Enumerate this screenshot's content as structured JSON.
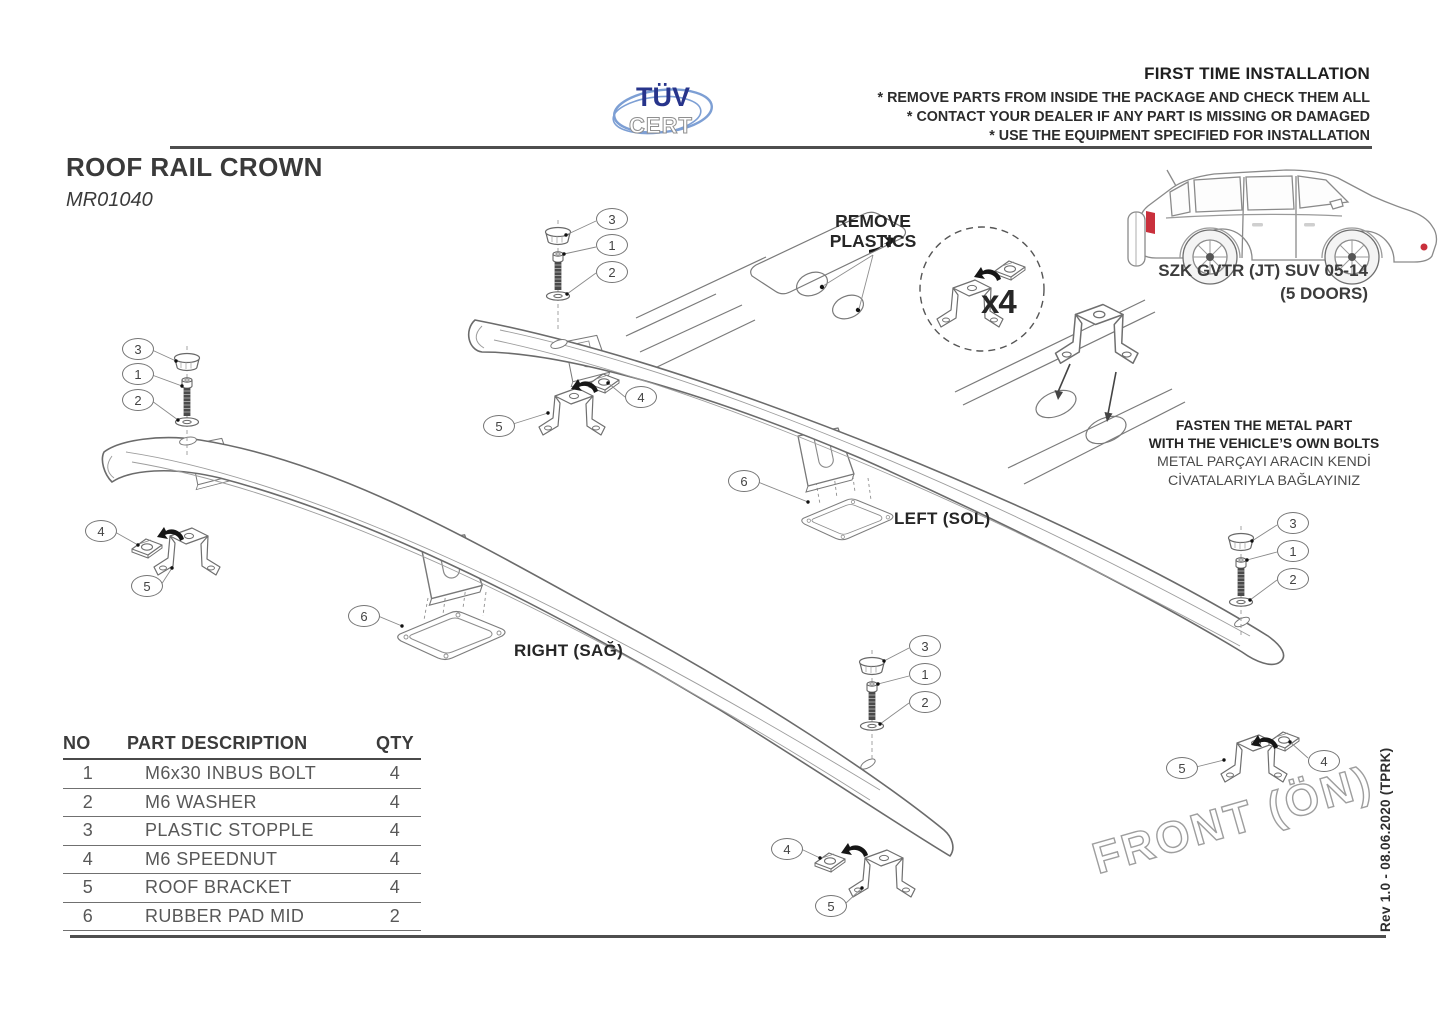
{
  "page": {
    "title": "ROOF RAIL CROWN",
    "code": "MR01040",
    "revision": "Rev 1.0 - 08.06.2020 (TPRK)"
  },
  "tuv_logo": {
    "top": "TÜV",
    "bottom": "CERT"
  },
  "first_time": {
    "title": "FIRST TIME INSTALLATION",
    "notes": [
      "* REMOVE PARTS FROM INSIDE THE PACKAGE AND CHECK THEM ALL",
      "* CONTACT YOUR DEALER IF ANY PART IS MISSING OR DAMAGED",
      "* USE THE EQUIPMENT SPECIFIED FOR INSTALLATION"
    ]
  },
  "vehicle": {
    "line1": "SZK GVTR (JT) SUV 05-14",
    "line2": "(5 DOORS)"
  },
  "annotations": {
    "remove_plastics_1": "REMOVE",
    "remove_plastics_2": "PLASTICS",
    "multiplier": "x4",
    "fasten_en_1": "FASTEN THE METAL PART",
    "fasten_en_2": "WITH THE VEHICLE’S OWN BOLTS",
    "fasten_tr_1": "METAL PARÇAYI ARACIN KENDİ",
    "fasten_tr_2": "CİVATALARIYLA BAĞLAYINIZ",
    "left_label": "LEFT (SOL)",
    "right_label": "RIGHT (SAĞ)",
    "front_label": "FRONT (ÖN)"
  },
  "callouts": [
    {
      "n": "3"
    },
    {
      "n": "1"
    },
    {
      "n": "2"
    },
    {
      "n": "3"
    },
    {
      "n": "1"
    },
    {
      "n": "2"
    },
    {
      "n": "3"
    },
    {
      "n": "1"
    },
    {
      "n": "2"
    },
    {
      "n": "3"
    },
    {
      "n": "1"
    },
    {
      "n": "2"
    },
    {
      "n": "4"
    },
    {
      "n": "5"
    },
    {
      "n": "5"
    },
    {
      "n": "4"
    },
    {
      "n": "4"
    },
    {
      "n": "5"
    },
    {
      "n": "5"
    },
    {
      "n": "4"
    },
    {
      "n": "6"
    },
    {
      "n": "6"
    }
  ],
  "parts_table": {
    "headers": [
      "NO",
      "PART DESCRIPTION",
      "QTY"
    ],
    "rows": [
      {
        "no": "1",
        "desc": "M6x30 INBUS BOLT",
        "qty": "4"
      },
      {
        "no": "2",
        "desc": "M6 WASHER",
        "qty": "4"
      },
      {
        "no": "3",
        "desc": "PLASTIC STOPPLE",
        "qty": "4"
      },
      {
        "no": "4",
        "desc": "M6 SPEEDNUT",
        "qty": "4"
      },
      {
        "no": "5",
        "desc": "ROOF BRACKET",
        "qty": "4"
      },
      {
        "no": "6",
        "desc": "RUBBER PAD MID",
        "qty": "2"
      }
    ]
  },
  "colors": {
    "tuv_dark_blue": "#27348b",
    "tuv_light_blue": "#7d9fd4",
    "line_gray": "#6e6e6e",
    "text_dark": "#3c3c3c",
    "red": "#c9303c"
  }
}
